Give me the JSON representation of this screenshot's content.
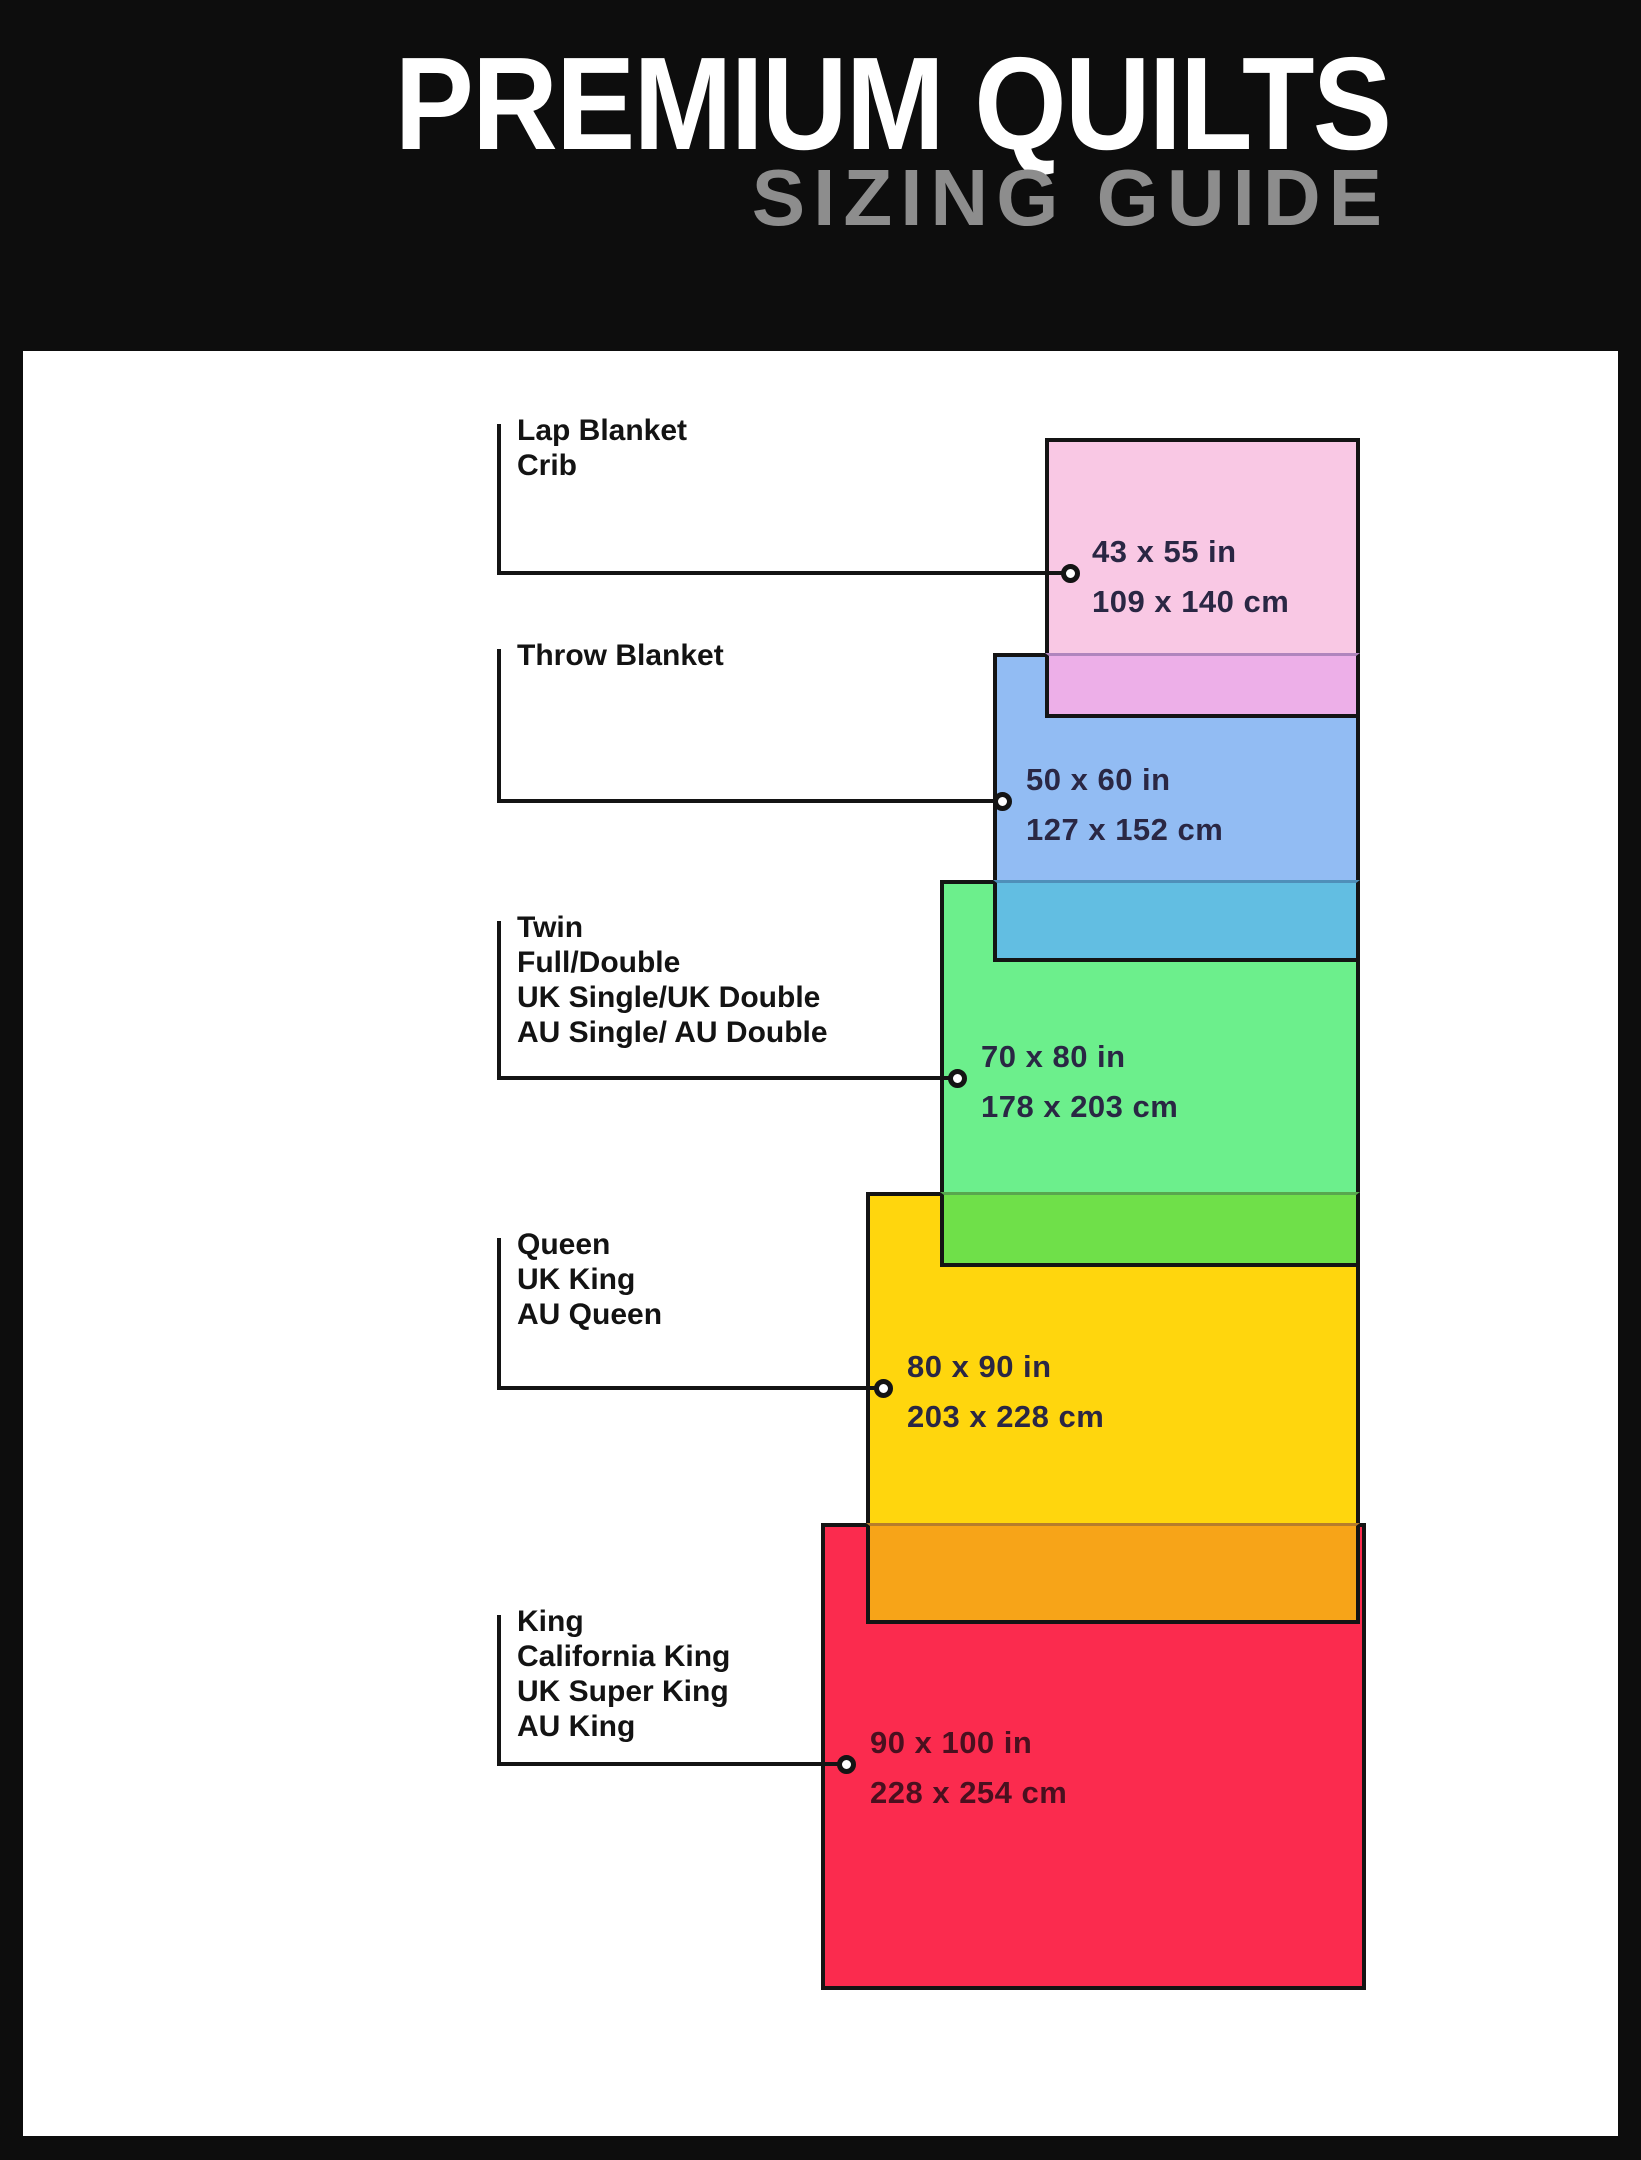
{
  "header": {
    "title": "PREMIUM QUILTS",
    "subtitle": "SIZING GUIDE"
  },
  "colors": {
    "page_background": "#0d0d0d",
    "panel_background": "#ffffff",
    "title_color": "#ffffff",
    "subtitle_color": "#8d8d8d",
    "line_color": "#141414",
    "label_color": "#131313",
    "size_text_color": "#2a2744"
  },
  "panel": {
    "left": 23,
    "top": 351,
    "width": 1595,
    "height": 1785
  },
  "connector_tick_x": 497,
  "items": [
    {
      "id": "lap-blanket-crib",
      "labels": [
        "Lap Blanket",
        "Crib"
      ],
      "size_in": "43 x 55 in",
      "size_cm": "109 x 140 cm",
      "fill": "#F9C8E4",
      "overlap_fill": "#EDAFE8",
      "text_color": "#2A2744",
      "rect": {
        "left": 1045,
        "top": 438,
        "right": 1360,
        "bottom": 718
      },
      "label_top": 420,
      "tick_top": 424,
      "conn_y": 573,
      "circle_x": 1070,
      "text_x": 1092
    },
    {
      "id": "throw-blanket",
      "labels": [
        "Throw Blanket"
      ],
      "size_in": "50 x 60 in",
      "size_cm": "127 x 152 cm",
      "fill": "#92BCF3",
      "overlap_fill": "#62BEE2",
      "text_color": "#2A2744",
      "rect": {
        "left": 993,
        "top": 653,
        "right": 1360,
        "bottom": 962
      },
      "label_top": 645,
      "tick_top": 649,
      "conn_y": 801,
      "circle_x": 1002,
      "text_x": 1026
    },
    {
      "id": "twin-full-double",
      "labels": [
        "Twin",
        "Full/Double",
        "UK Single/UK Double",
        "AU Single/ AU Double"
      ],
      "size_in": "70 x 80 in",
      "size_cm": "178 x 203 cm",
      "fill": "#6CEF8C",
      "overlap_fill": "#6FE049",
      "text_color": "#2A2744",
      "rect": {
        "left": 940,
        "top": 880,
        "right": 1360,
        "bottom": 1267
      },
      "label_top": 917,
      "tick_top": 921,
      "conn_y": 1078,
      "circle_x": 957,
      "text_x": 981
    },
    {
      "id": "queen",
      "labels": [
        "Queen",
        "UK King",
        "AU Queen"
      ],
      "size_in": "80 x 90 in",
      "size_cm": "203 x 228 cm",
      "fill": "#FFD60D",
      "overlap_fill": "#F7A418",
      "text_color": "#2A2744",
      "rect": {
        "left": 866,
        "top": 1192,
        "right": 1360,
        "bottom": 1624
      },
      "label_top": 1234,
      "tick_top": 1238,
      "conn_y": 1388,
      "circle_x": 883,
      "text_x": 907
    },
    {
      "id": "king",
      "labels": [
        "King",
        "California King",
        "UK Super King",
        "AU King"
      ],
      "size_in": "90 x 100 in",
      "size_cm": "228 x 254 cm",
      "fill": "#FB2B4E",
      "overlap_fill": null,
      "text_color": "#49101F",
      "rect": {
        "left": 821,
        "top": 1523,
        "right": 1366,
        "bottom": 1990
      },
      "label_top": 1611,
      "tick_top": 1615,
      "conn_y": 1764,
      "circle_x": 846,
      "text_x": 870
    }
  ]
}
